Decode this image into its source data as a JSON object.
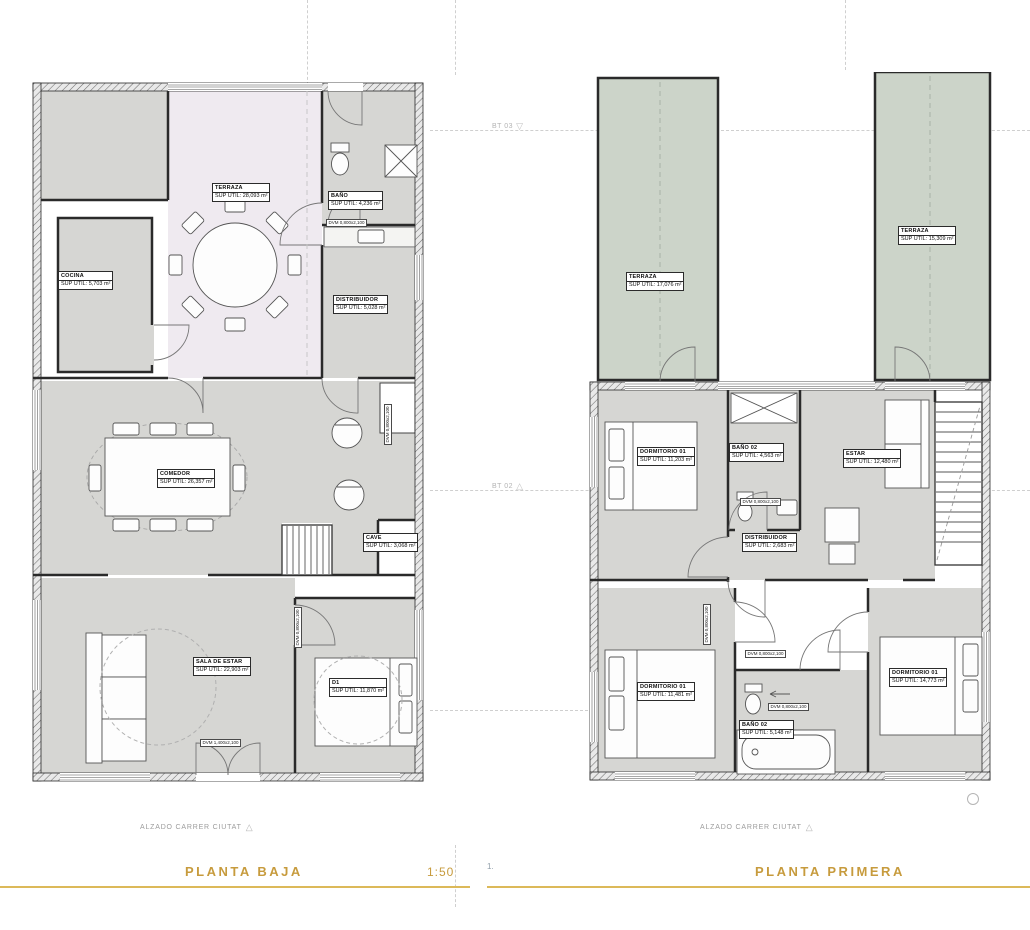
{
  "colors": {
    "accent_gold": "#c79b3d",
    "room_gray": "#d6d6d3",
    "terrace_lilac": "#efeaf0",
    "terrace_green": "#ccd4c9",
    "wall": "#2a2a2a",
    "dash_gray": "#cfcfcf"
  },
  "footer": {
    "left_title": "PLANTA BAJA",
    "left_scale": "1:50",
    "right_index": "1.",
    "right_title": "PLANTA PRIMERA"
  },
  "annotations": {
    "alzado_left": "ALZADO CARRER CIUTAT",
    "alzado_right": "ALZADO CARRER CIUTAT",
    "triangle": "△",
    "triangle_down": "▽",
    "marker_top": "BT 03",
    "marker_mid": "BT 02"
  },
  "door_tags": {
    "small": "DVM 0,800x2,100",
    "entry": "DVM 1,400x2,100"
  },
  "plans": [
    {
      "title": "PLANTA BAJA",
      "rooms": [
        {
          "name": "TERRAZA",
          "area": "SUP ÚTIL: 28,093 m²"
        },
        {
          "name": "COCINA",
          "area": "SUP ÚTIL: 5,703 m²"
        },
        {
          "name": "BAÑO",
          "area": "SUP ÚTIL: 4,236 m²"
        },
        {
          "name": "DISTRIBUIDOR",
          "area": "SUP ÚTIL: 5,028 m²"
        },
        {
          "name": "COMEDOR",
          "area": "SUP ÚTIL: 26,357 m²"
        },
        {
          "name": "CAVE",
          "area": "SUP ÚTIL: 3,068 m²"
        },
        {
          "name": "SALA DE ESTAR",
          "area": "SUP ÚTIL: 22,903 m²"
        },
        {
          "name": "D1",
          "area": "SUP ÚTIL: 11,870 m²"
        }
      ]
    },
    {
      "title": "PLANTA PRIMERA",
      "rooms": [
        {
          "name": "TERRAZA",
          "area": "SUP ÚTIL: 17,076 m²"
        },
        {
          "name": "TERRAZA",
          "area": "SUP ÚTIL: 15,309 m²"
        },
        {
          "name": "DORMITORIO 01",
          "area": "SUP ÚTIL: 11,203 m²"
        },
        {
          "name": "BAÑO 02",
          "area": "SUP ÚTIL: 4,563 m²"
        },
        {
          "name": "ESTAR",
          "area": "SUP ÚTIL: 12,480 m²"
        },
        {
          "name": "DISTRIBUIDOR",
          "area": "SUP ÚTIL: 2,683 m²"
        },
        {
          "name": "DORMITORIO 01",
          "area": "SUP ÚTIL: 11,481 m²"
        },
        {
          "name": "BAÑO 02",
          "area": "SUP ÚTIL: 5,148 m²"
        },
        {
          "name": "DORMITORIO 01",
          "area": "SUP ÚTIL: 14,773 m²"
        }
      ]
    }
  ]
}
